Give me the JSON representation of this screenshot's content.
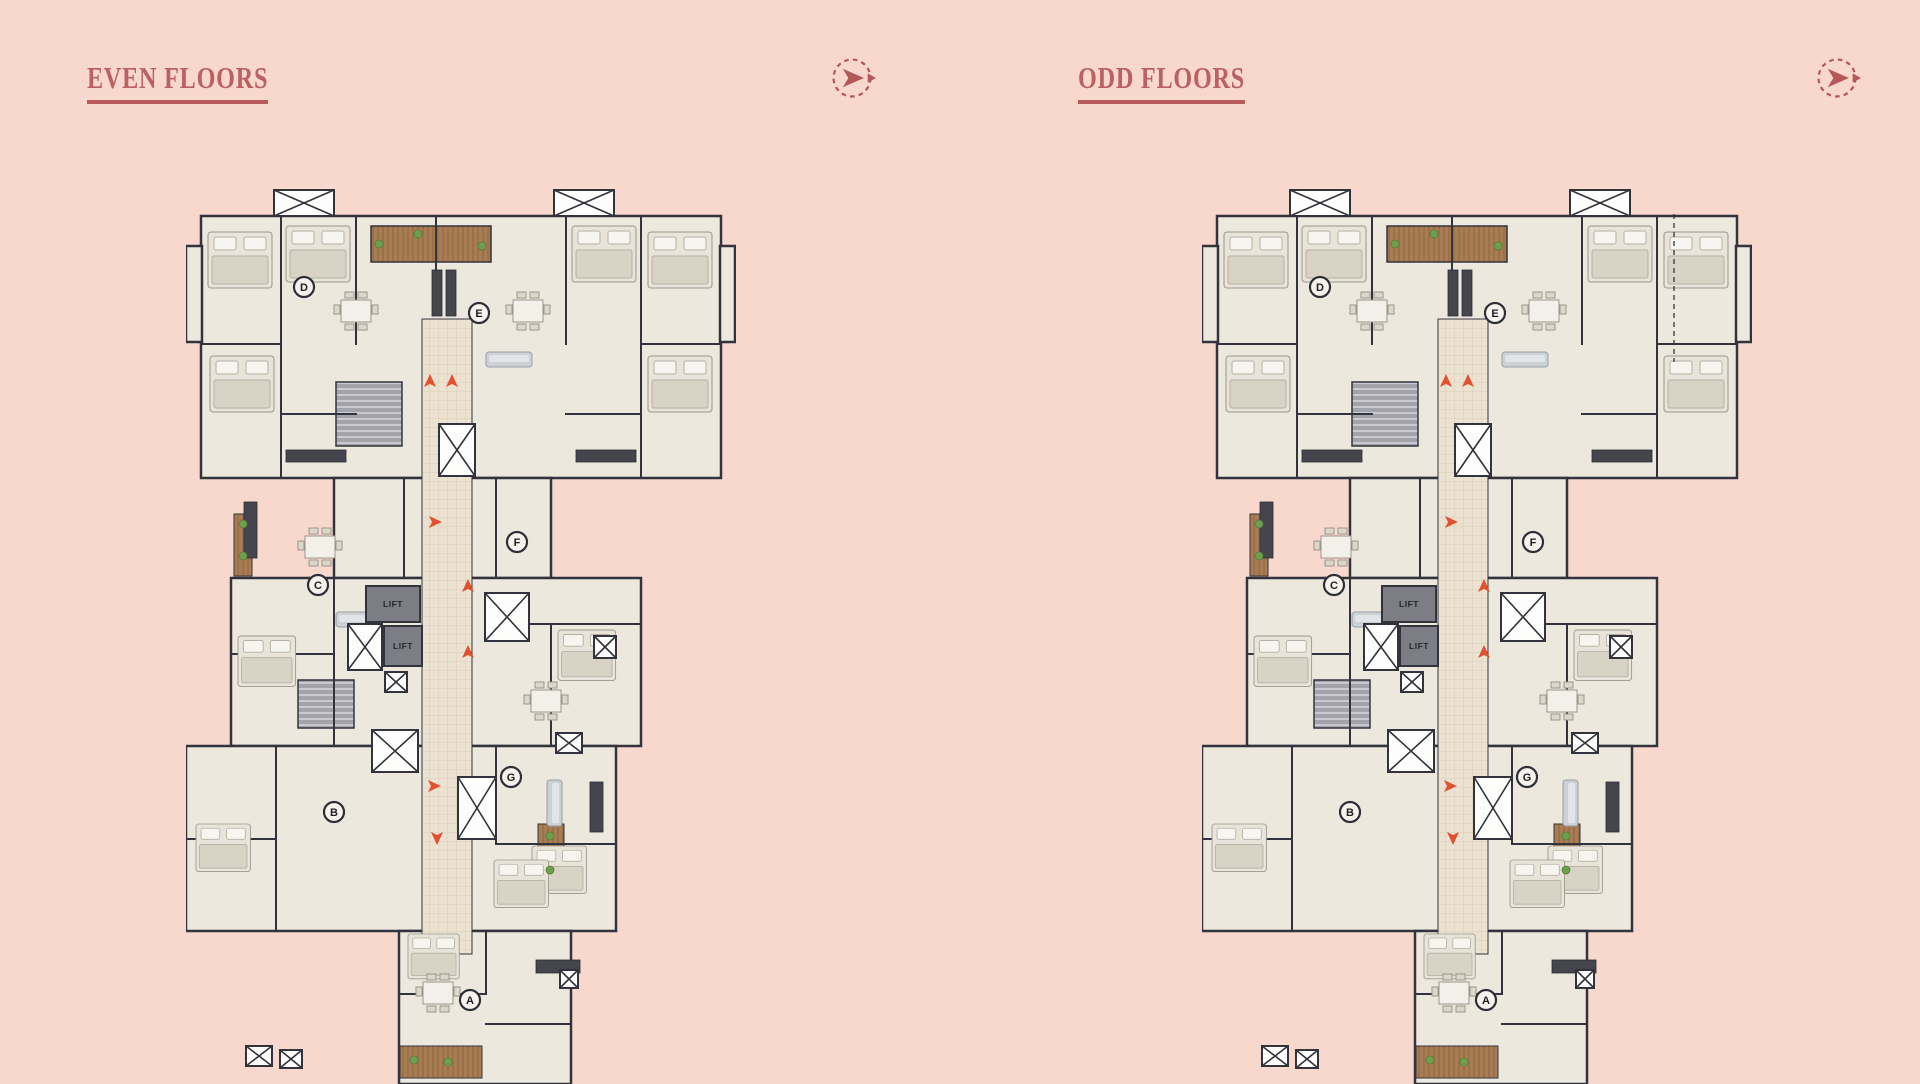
{
  "page": {
    "background_color": "#f8d7cd"
  },
  "panels": [
    {
      "title": "EVEN FLOORS"
    },
    {
      "title": "ODD FLOORS"
    }
  ],
  "nav": {
    "icon": "paper-plane-next-icon",
    "color": "#b5585a"
  },
  "theme": {
    "title_color": "#bb6164",
    "underline_color": "#b65a5c",
    "background": "#f8d7cd"
  },
  "floor_plan": {
    "lift_label": "LIFT",
    "units": [
      {
        "label": "A",
        "x": 284,
        "y": 816
      },
      {
        "label": "B",
        "x": 148,
        "y": 628
      },
      {
        "label": "C",
        "x": 132,
        "y": 401
      },
      {
        "label": "D",
        "x": 118,
        "y": 103
      },
      {
        "label": "E",
        "x": 293,
        "y": 129
      },
      {
        "label": "F",
        "x": 331,
        "y": 358
      },
      {
        "label": "G",
        "x": 325,
        "y": 593
      }
    ],
    "lifts": [
      {
        "x": 180,
        "y": 402,
        "w": 54,
        "h": 36
      },
      {
        "x": 198,
        "y": 442,
        "w": 38,
        "h": 40
      }
    ],
    "shafts": [
      [
        88,
        6,
        60,
        26
      ],
      [
        368,
        6,
        60,
        26
      ],
      [
        253,
        240,
        36,
        52
      ],
      [
        299,
        409,
        44,
        48
      ],
      [
        162,
        440,
        34,
        46
      ],
      [
        199,
        488,
        22,
        20
      ],
      [
        186,
        546,
        46,
        42
      ],
      [
        272,
        593,
        38,
        62
      ],
      [
        370,
        549,
        26,
        20
      ],
      [
        408,
        452,
        22,
        22
      ],
      [
        374,
        786,
        18,
        18
      ],
      [
        60,
        862,
        26,
        20
      ],
      [
        94,
        866,
        22,
        18
      ]
    ],
    "arrows": [
      {
        "x": 244,
        "y": 199,
        "rot": 0
      },
      {
        "x": 266,
        "y": 199,
        "rot": 0
      },
      {
        "x": 247,
        "y": 338,
        "rot": 90
      },
      {
        "x": 282,
        "y": 404,
        "rot": 0
      },
      {
        "x": 282,
        "y": 470,
        "rot": 0
      },
      {
        "x": 246,
        "y": 602,
        "rot": 90
      },
      {
        "x": 251,
        "y": 652,
        "rot": 180
      }
    ],
    "colors": {
      "wall": "#33333d",
      "room": "#ece8de",
      "corridor_tile": "#ebe2d1",
      "lift_fill": "#7d7d85",
      "lift_text": "#26262e",
      "shaft_fill": "#fdfdfb",
      "arrow": "#e2512f",
      "wood": "#a87d53",
      "stairs": "#a3a3ab",
      "plant": "#6f9e4e",
      "unit_ring": "#2e2e36",
      "unit_fill": "#f6f3ec"
    }
  }
}
